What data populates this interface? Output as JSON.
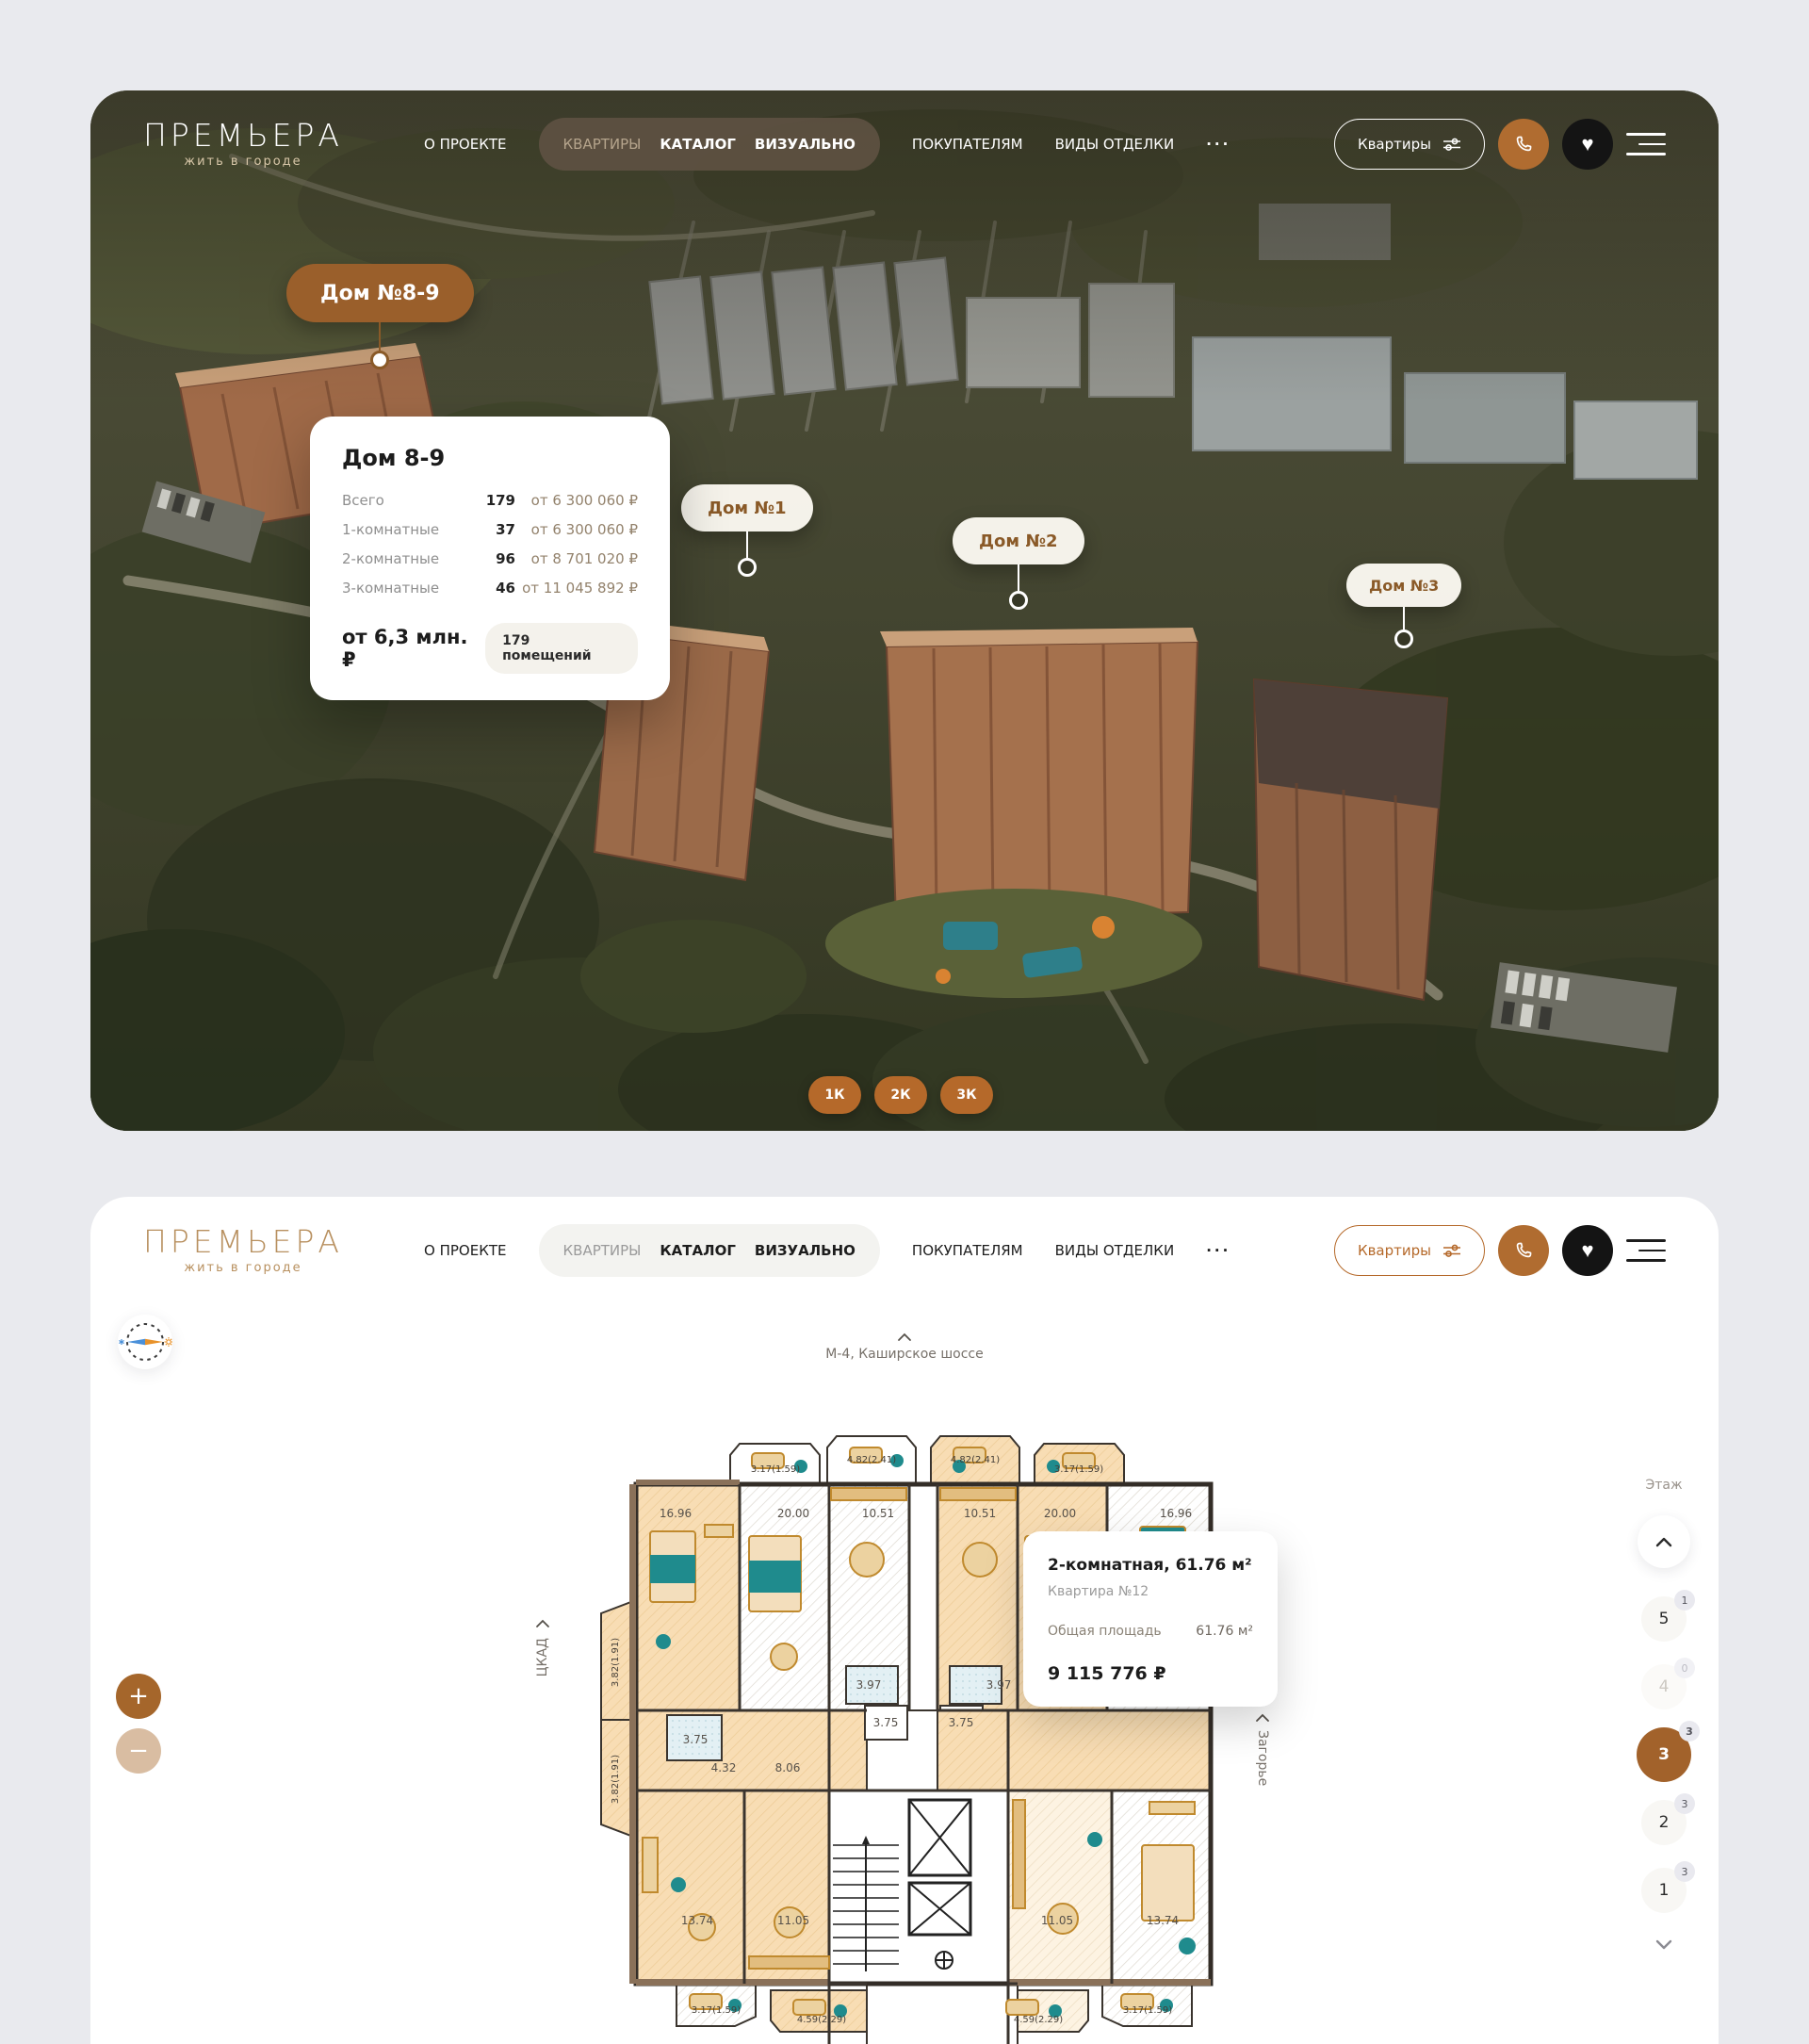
{
  "header": {
    "logo_title": "ПРЕМЬЕРА",
    "logo_subtitle": "жить в городе",
    "nav_about": "О ПРОЕКТЕ",
    "nav_flats": "КВАРТИРЫ",
    "nav_catalog": "КАТАЛОГ",
    "nav_visual": "ВИЗУАЛЬНО",
    "nav_buyers": "ПОКУПАТЕЛЯМ",
    "nav_finishes": "ВИДЫ ОТДЕЛКИ",
    "nav_more": "···",
    "flats_button": "Квартиры"
  },
  "masterplan": {
    "marker_house89": "Дом №8-9",
    "marker_house1": "Дом №1",
    "marker_house2": "Дом №2",
    "marker_house3": "Дом №3",
    "popup": {
      "title": "Дом 8-9",
      "rows": [
        {
          "label": "Всего",
          "count": "179",
          "price": "от 6 300 060 ₽"
        },
        {
          "label": "1-комнатные",
          "count": "37",
          "price": "от 6 300 060 ₽"
        },
        {
          "label": "2-комнатные",
          "count": "96",
          "price": "от 8 701 020 ₽"
        },
        {
          "label": "3-комнатные",
          "count": "46",
          "price": "от 11 045 892 ₽"
        }
      ],
      "from_price": "от 6,3 млн. ₽",
      "badge": "179 помещений"
    },
    "filters": [
      "1К",
      "2К",
      "3К"
    ]
  },
  "floorplan": {
    "road_top": "М-4, Каширское шоссе",
    "road_left": "ЦКАД",
    "road_right": "Загорье",
    "floor_label": "Этаж",
    "floors": [
      {
        "num": "5",
        "badge": "1"
      },
      {
        "num": "4",
        "badge": "0"
      },
      {
        "num": "3",
        "badge": "3"
      },
      {
        "num": "2",
        "badge": "3"
      },
      {
        "num": "1",
        "badge": "3"
      }
    ],
    "popup": {
      "title": "2-комнатная, 61.76 м²",
      "subtitle": "Квартира №12",
      "area_label": "Общая площадь",
      "area_value": "61.76 м²",
      "price": "9 115 776 ₽"
    },
    "dims": {
      "d317": "3.17(1.59)",
      "d482": "4.82(2.41)",
      "d459": "4.59(2.29)",
      "d382": "3.82(1.91)",
      "a1696": "16.96",
      "a2000": "20.00",
      "a1051": "10.51",
      "a1374": "13.74",
      "a1105": "11.05",
      "a397": "3.97",
      "a375": "3.75",
      "a432": "4.32",
      "a806": "8.06"
    }
  },
  "colors": {
    "accent": "#a2622b",
    "marker_brown": "#9a5f2b",
    "logo_gold": "#b8905f",
    "plan_peach": "#f7ddb5",
    "plan_teal": "#1f8b8d"
  }
}
